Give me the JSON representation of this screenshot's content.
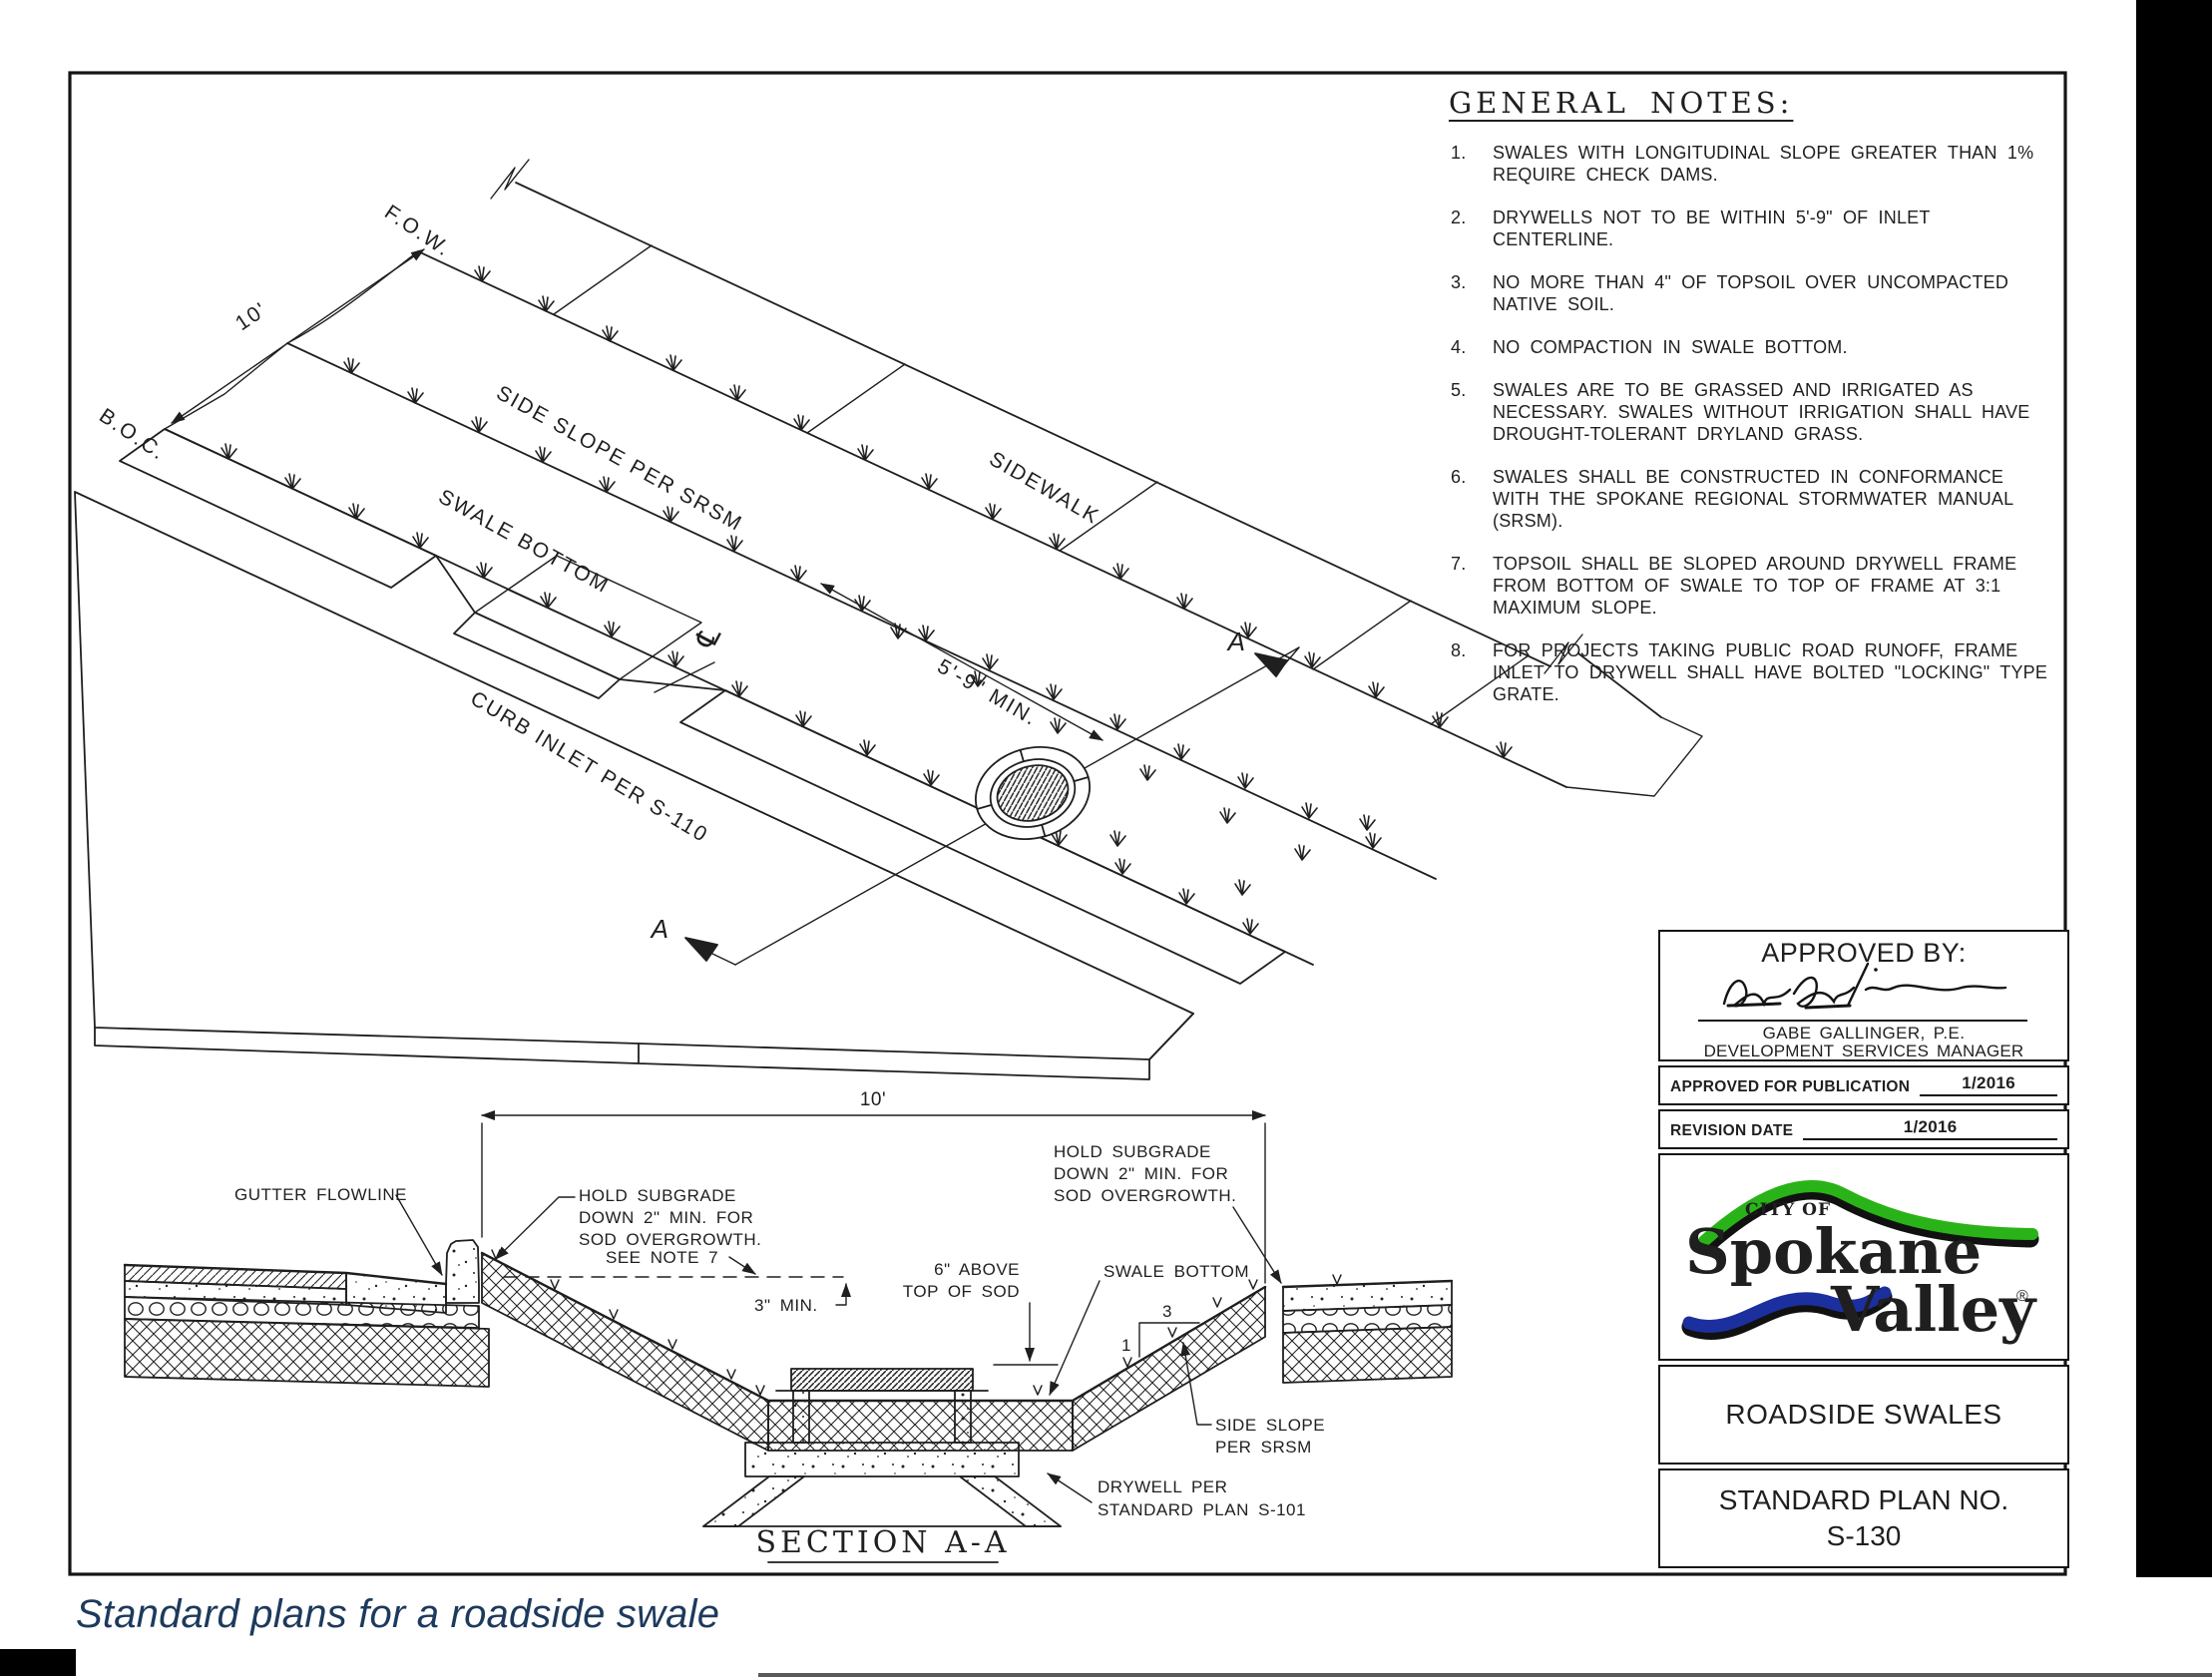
{
  "caption": "Standard plans for a roadside swale",
  "colors": {
    "line": "#1f1f1f",
    "caption_text": "#1d3a5c",
    "logo_green": "#2ab318",
    "logo_blue": "#1b2f9e",
    "logo_black": "#111111"
  },
  "drawing": {
    "general_notes": {
      "title": "GENERAL NOTES:",
      "items": [
        {
          "num": "1.",
          "text": "SWALES WITH LONGITUDINAL SLOPE GREATER THAN 1% REQUIRE CHECK DAMS."
        },
        {
          "num": "2.",
          "text": "DRYWELLS NOT TO BE WITHIN 5'-9\" OF INLET CENTERLINE."
        },
        {
          "num": "3.",
          "text": "NO MORE THAN 4\" OF TOPSOIL OVER UNCOMPACTED NATIVE SOIL."
        },
        {
          "num": "4.",
          "text": "NO COMPACTION IN SWALE BOTTOM."
        },
        {
          "num": "5.",
          "text": "SWALES ARE TO BE GRASSED AND IRRIGATED AS NECESSARY. SWALES WITHOUT IRRIGATION SHALL HAVE DROUGHT-TOLERANT DRYLAND GRASS."
        },
        {
          "num": "6.",
          "text": "SWALES SHALL BE CONSTRUCTED IN CONFORMANCE WITH THE SPOKANE REGIONAL STORMWATER MANUAL (SRSM)."
        },
        {
          "num": "7.",
          "text": "TOPSOIL SHALL BE SLOPED AROUND DRYWELL FRAME FROM BOTTOM OF SWALE TO TOP OF FRAME AT 3:1 MAXIMUM SLOPE."
        },
        {
          "num": "8.",
          "text": "FOR PROJECTS TAKING PUBLIC ROAD RUNOFF, FRAME INLET TO DRYWELL SHALL HAVE BOLTED \"LOCKING\" TYPE GRATE."
        }
      ]
    },
    "iso": {
      "fow": "F.O.W.",
      "boc": "B.O.C.",
      "dim_10": "10'",
      "side_slope": "SIDE SLOPE PER SRSM",
      "swale_bottom": "SWALE BOTTOM",
      "curb_inlet": "CURB INLET PER S-110",
      "sidewalk": "SIDEWALK",
      "dim_5_9": "5'-9\" MIN.",
      "centerline": "℄",
      "section_marker_top": "A",
      "section_marker_bottom": "A"
    },
    "section": {
      "title": "SECTION A-A",
      "dim_10": "10'",
      "gutter_flowline": "GUTTER FLOWLINE",
      "hold_subgrade_left": [
        "HOLD SUBGRADE",
        "DOWN 2\" MIN. FOR",
        "SOD OVERGROWTH."
      ],
      "hold_subgrade_right": [
        "HOLD SUBGRADE",
        "DOWN 2\" MIN. FOR",
        "SOD OVERGROWTH."
      ],
      "see_note": "SEE NOTE 7",
      "min_3": "3\" MIN.",
      "above_sod": [
        "6\" ABOVE",
        "TOP OF SOD"
      ],
      "swale_bottom": "SWALE BOTTOM",
      "slope_run": "3",
      "slope_rise": "1",
      "side_slope": [
        "SIDE SLOPE",
        "PER SRSM"
      ],
      "drywell": [
        "DRYWELL PER",
        "STANDARD PLAN S-101"
      ]
    },
    "title_block": {
      "approved_by": "APPROVED BY:",
      "signee": "GABE GALLINGER, P.E.",
      "signee_title": "DEVELOPMENT SERVICES MANAGER",
      "approved_for_publication_label": "APPROVED FOR PUBLICATION",
      "approved_for_publication_value": "1/2016",
      "revision_date_label": "REVISION DATE",
      "revision_date_value": "1/2016",
      "logo": {
        "city_of": "CITY OF",
        "name1": "Spokane",
        "name2": "Valley",
        "reg": "®"
      },
      "plan_title": "ROADSIDE SWALES",
      "plan_no_label": "STANDARD PLAN NO.",
      "plan_no": "S-130"
    }
  }
}
